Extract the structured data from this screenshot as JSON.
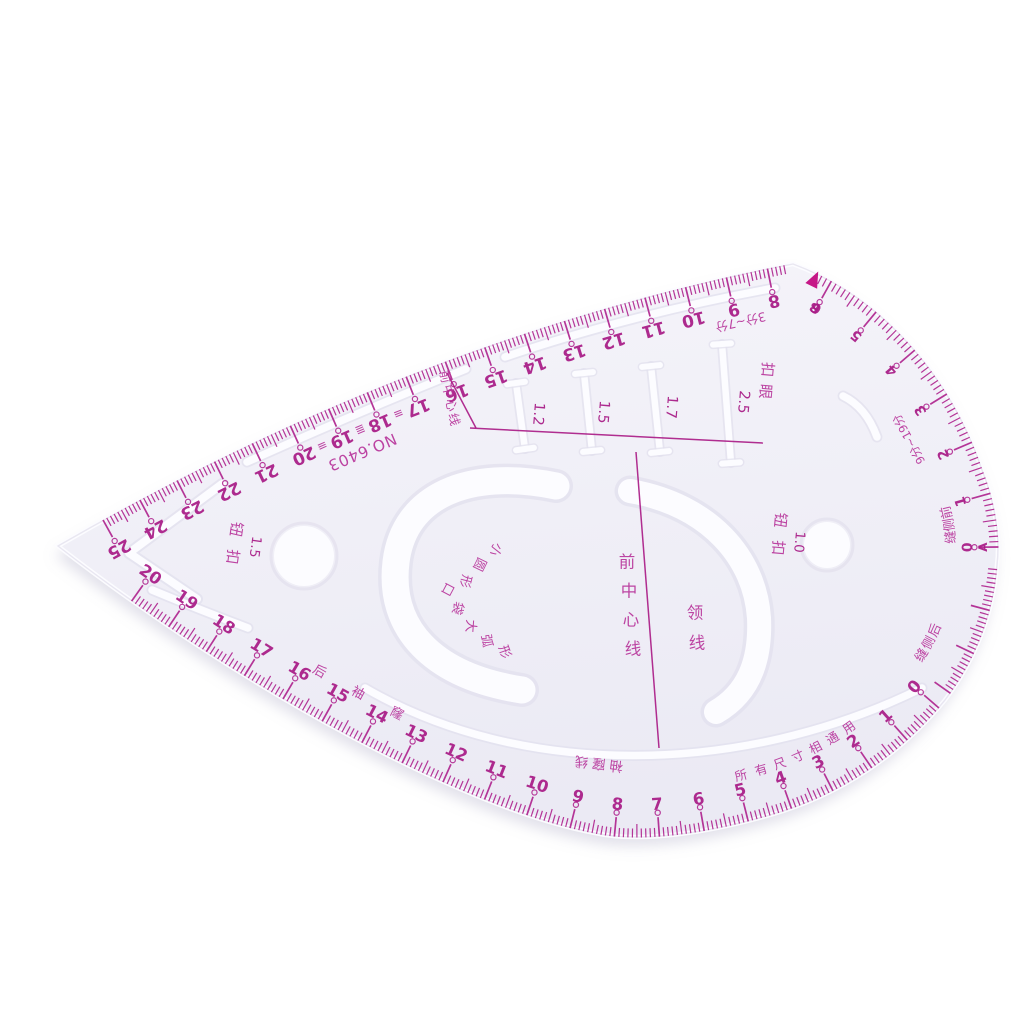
{
  "scene": {
    "background": "#ffffff"
  },
  "ruler": {
    "body_fill_top": "#f5f4fa",
    "body_fill_bottom": "#ebeaf4",
    "body_edge_shade": "#e3e1ee",
    "body_edge_highlight": "#fcfcff",
    "cut_shade": "#e2e0ed",
    "cut_white": "#fcfcff",
    "ink": {
      "tick": "#b02790",
      "number": "#a81a86",
      "label": "#b8359b",
      "line": "#a81784",
      "arrow": "#c30b81"
    },
    "model": "NO.6403",
    "scales": {
      "top": {
        "numbers": [
          25,
          24,
          23,
          22,
          21,
          20,
          19,
          18,
          17,
          16,
          15,
          14,
          13,
          12,
          11,
          10,
          9,
          8
        ],
        "hatch_marks": [
          "≡",
          "≣",
          "≡"
        ],
        "note": "3分~7分"
      },
      "side": {
        "numbers": [
          6,
          5,
          4,
          3,
          2,
          1,
          0
        ],
        "zero_letter": "A",
        "point_label": "B",
        "note": "9分~19分",
        "seam_label": "前侧缝"
      },
      "bottom": {
        "numbers": [
          0,
          1,
          2,
          3,
          4,
          5,
          6,
          7,
          8,
          9,
          10,
          11,
          12,
          13,
          14,
          15,
          16,
          17,
          18,
          19,
          20
        ],
        "seam_label": "后侧缝",
        "armhole_label": "后袖窿",
        "universal_note": "所有尺寸相通用"
      }
    },
    "buttonholes": {
      "label": "扣眼",
      "sizes": [
        "1.2",
        "1.5",
        "1.7",
        "2.5"
      ]
    },
    "buttons": {
      "left": {
        "label": "钮 扣",
        "size": "1.5"
      },
      "right": {
        "label": "钮 扣",
        "size": "1.0"
      }
    },
    "lines": {
      "front_center_diagonal": "前中心线",
      "front_center": "前中心线",
      "neck": "领线",
      "armhole_line": "袖窿线"
    },
    "cutouts": {
      "small_circle": "小圆形",
      "pocket_arc": "口袋大弧形"
    }
  }
}
